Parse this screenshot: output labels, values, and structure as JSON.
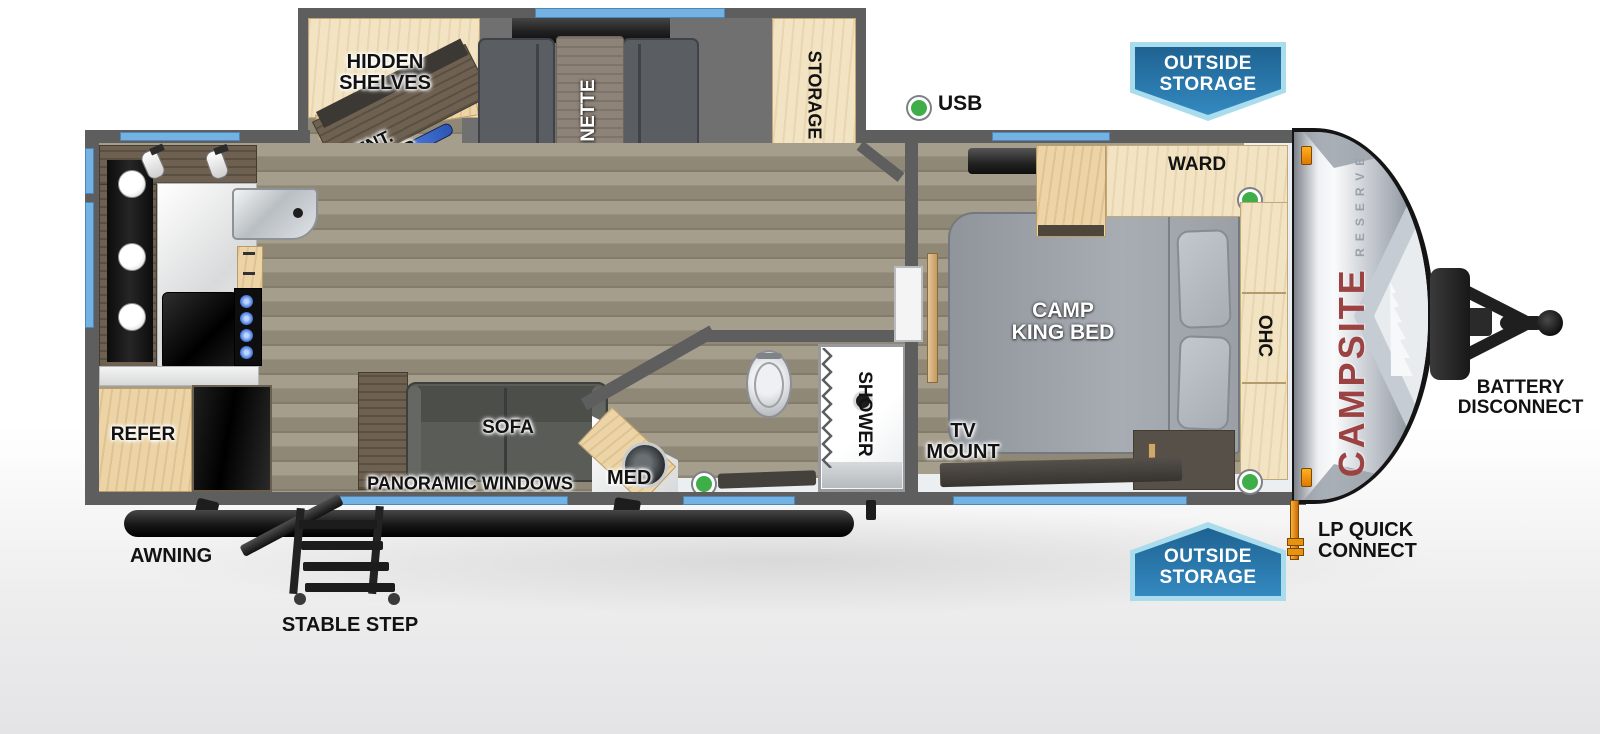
{
  "fp": {
    "slide": {
      "hidden_shelves": "HIDDEN\nSHELVES",
      "ent_center": "ENT.\nCENTER",
      "fireplace": "FIREPLACE",
      "dinette": "DINETTE",
      "storage": "STORAGE"
    },
    "kitchen": {
      "refer": "REFER"
    },
    "living": {
      "sofa": "SOFA",
      "panoramic_windows": "PANORAMIC WINDOWS"
    },
    "bath": {
      "med": "MED",
      "shower": "SHOWER"
    },
    "bedroom": {
      "ward": "WARD",
      "bed": "CAMP\nKING BED",
      "ohc": "OHC",
      "tv_mount": "TV\nMOUNT"
    },
    "callouts": {
      "usb": "USB",
      "outside_storage_top": "OUTSIDE\nSTORAGE",
      "outside_storage_bottom": "OUTSIDE\nSTORAGE",
      "awning": "AWNING",
      "stable_step": "STABLE STEP",
      "battery_disconnect": "BATTERY\nDISCONNECT",
      "lp_quick_connect": "LP QUICK\nCONNECT"
    },
    "brand": {
      "name": "CAMPSITE",
      "sub": "RESERVE"
    },
    "colors": {
      "wall": "#5e5e5e",
      "window": "#74b2e2",
      "wood": "#ecd4a7",
      "banner_top": "#1e6392",
      "banner_bottom": "#3489c0",
      "banner_border": "#a9dced",
      "green": "#3fae49",
      "brand_red": "#9b4242",
      "fire_blue": "#4a7ade",
      "fire_orange": "#e87816"
    }
  }
}
